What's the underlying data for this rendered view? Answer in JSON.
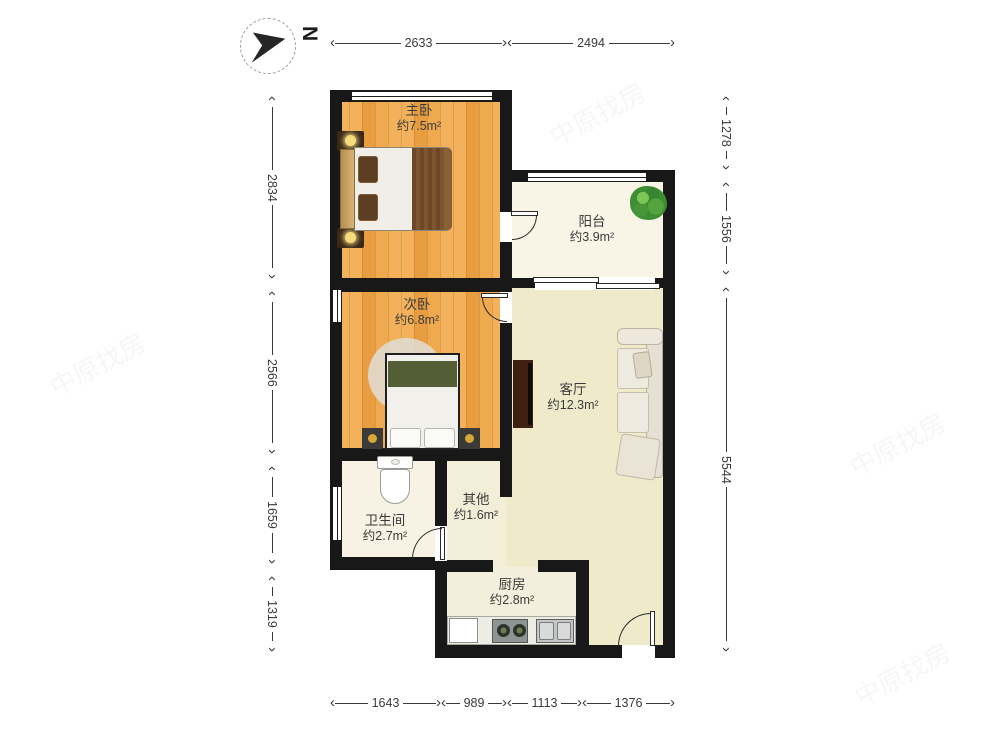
{
  "compass": {
    "north_label": "N"
  },
  "rooms": [
    {
      "id": "master-bedroom",
      "name": "主卧",
      "area": "约7.5m²"
    },
    {
      "id": "balcony",
      "name": "阳台",
      "area": "约3.9m²"
    },
    {
      "id": "second-bedroom",
      "name": "次卧",
      "area": "约6.8m²"
    },
    {
      "id": "living-room",
      "name": "客厅",
      "area": "约12.3m²"
    },
    {
      "id": "bathroom",
      "name": "卫生间",
      "area": "约2.7m²"
    },
    {
      "id": "other",
      "name": "其他",
      "area": "约1.6m²"
    },
    {
      "id": "kitchen",
      "name": "厨房",
      "area": "约2.8m²"
    }
  ],
  "dimensions_mm": {
    "top": [
      "2633",
      "2494"
    ],
    "bottom": [
      "1643",
      "989",
      "1113",
      "1376"
    ],
    "left": [
      "2834",
      "2566",
      "1659",
      "1319"
    ],
    "right": [
      "1278",
      "1556",
      "5544"
    ]
  },
  "watermark": {
    "text": "中原找房"
  },
  "colors": {
    "wall": "#181818",
    "wood_floor": "#efa94e",
    "balcony_floor": "#f8f4e6",
    "living_floor": "#efebca",
    "bathroom_floor": "#f7f2e3",
    "kitchen_floor": "#f4efdc",
    "dimension_text": "#3a3a3a"
  }
}
